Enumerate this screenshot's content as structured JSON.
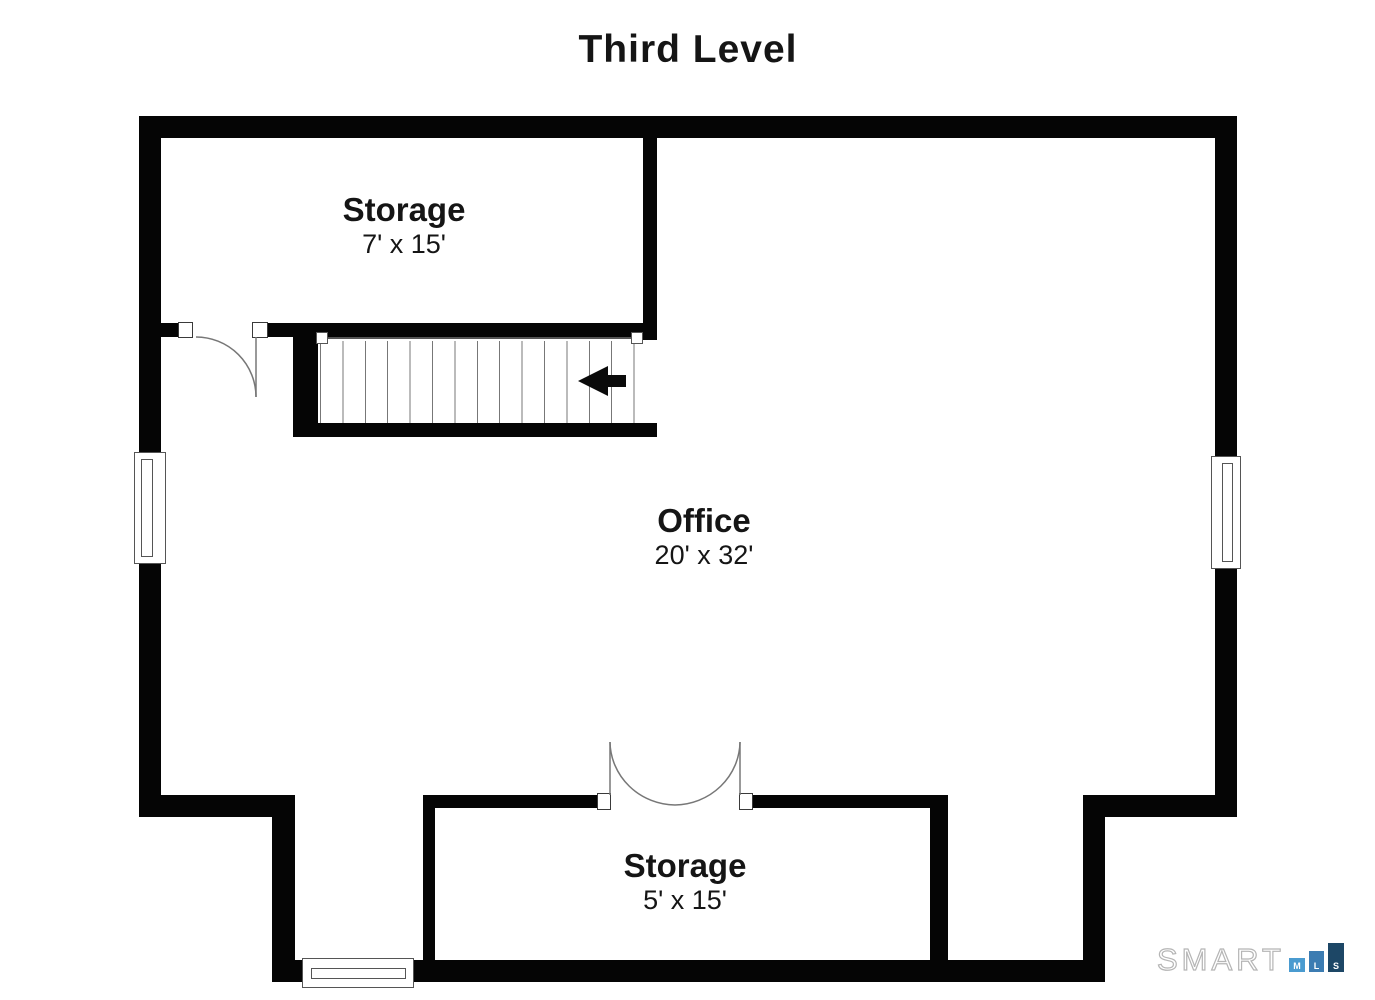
{
  "title": "Third Level",
  "rooms": {
    "storage_top": {
      "name": "Storage",
      "dims": "7' x 15'"
    },
    "office": {
      "name": "Office",
      "dims": "20' x 32'"
    },
    "storage_bottom": {
      "name": "Storage",
      "dims": "5' x 15'"
    }
  },
  "stairs": {
    "direction": "left",
    "tread_count": 14
  },
  "logo": {
    "brand": "SMART",
    "squares": [
      {
        "letter": "M",
        "color": "#4a9bd0"
      },
      {
        "letter": "L",
        "color": "#3c7cb2"
      },
      {
        "letter": "S",
        "color": "#1d4766"
      }
    ]
  },
  "colors": {
    "wall": "#050505",
    "line": "#777777",
    "background": "#ffffff"
  }
}
